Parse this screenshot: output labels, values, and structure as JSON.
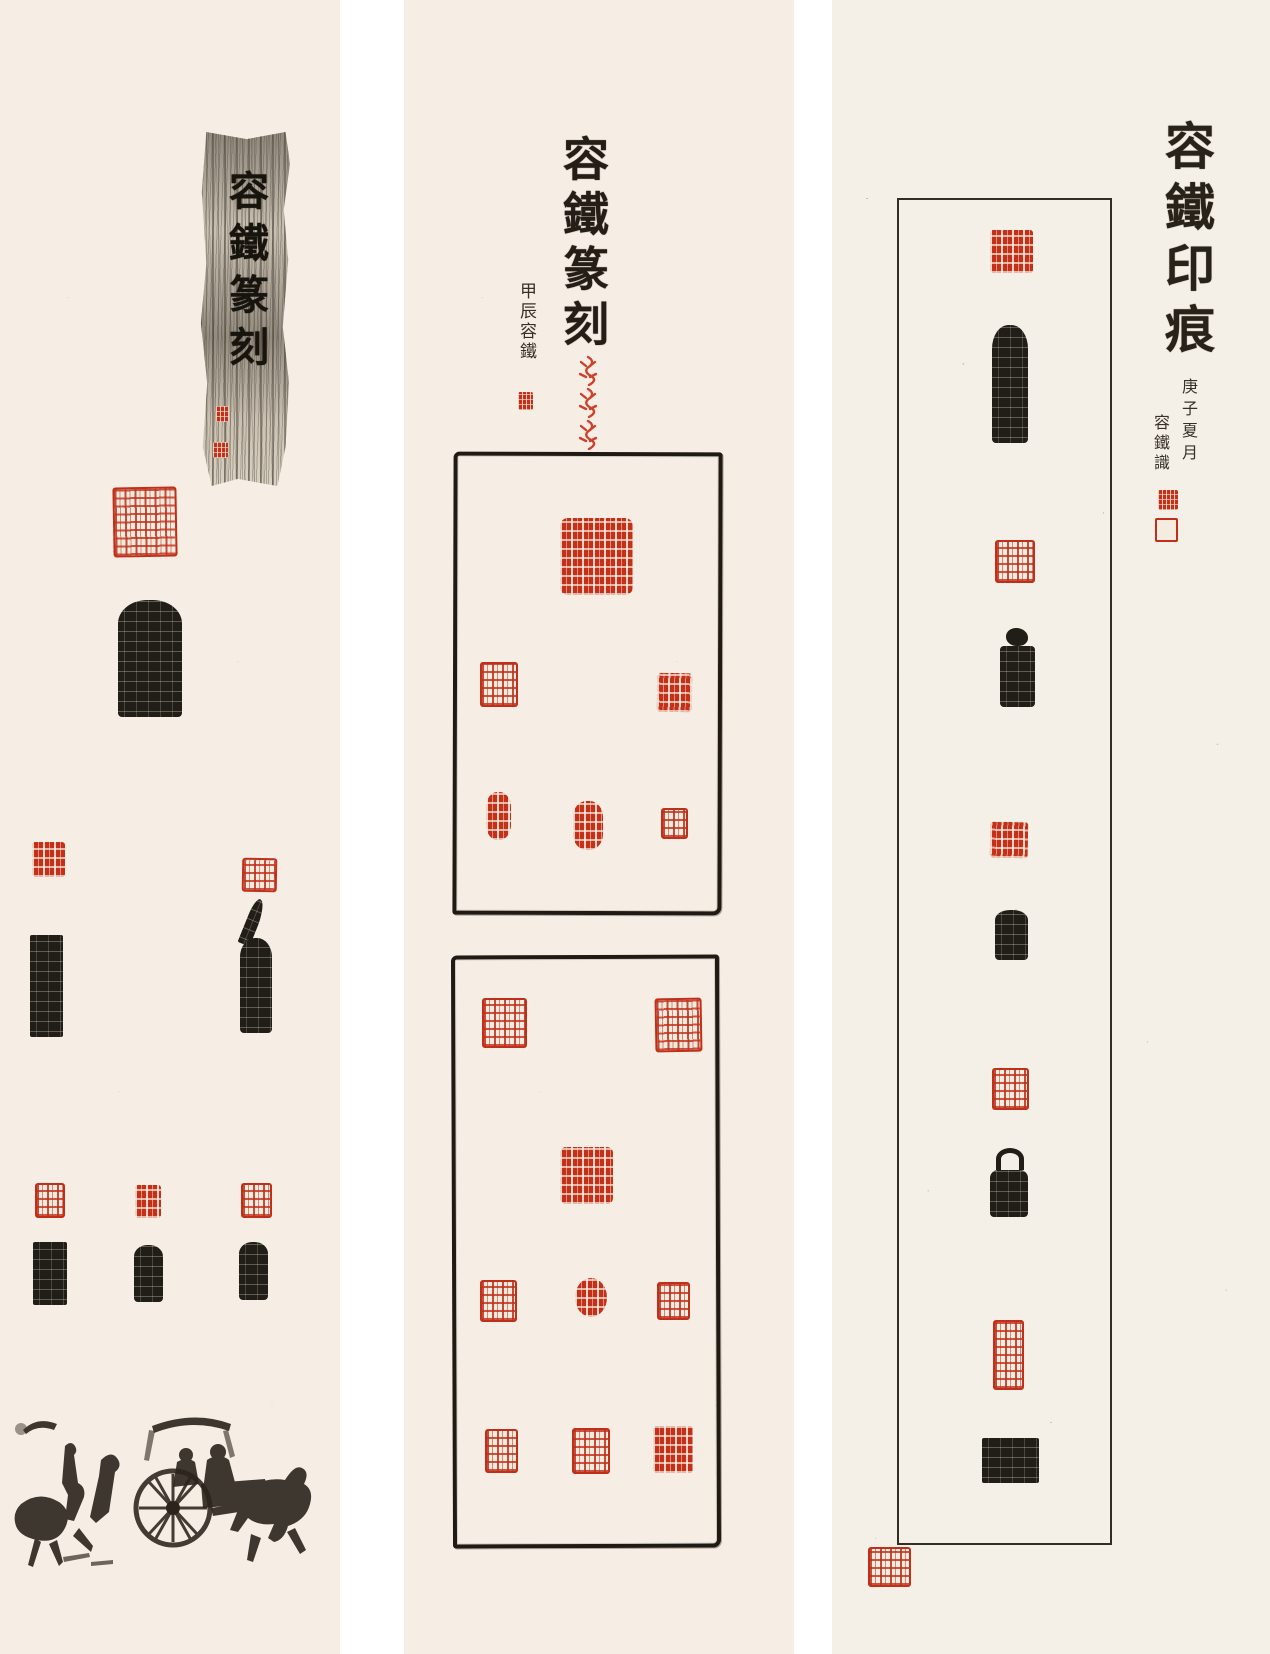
{
  "artwork": {
    "title": "容鐵篆刻 · 容鐵印痕 — Chinese seal-carving (zhuanke) triptych",
    "description": "Three vertical cream paper scrolls displaying seal carving art: red seal impressions, black seal-stone side-inscription rubbings, brush calligraphy titles, and a Han-dynasty style horse-and-chariot ink rubbing.",
    "colors": {
      "paper": "#f6eee4",
      "paper_right": "#f5f0e7",
      "gap": "#ffffff",
      "ink": "#211d17",
      "seal_red": "#c43018"
    }
  },
  "left_panel": {
    "title": "容鐵篆刻",
    "title_style": "black brush characters on a mottled gray ink-rubbing strip",
    "title_strip_seals": [
      "small red seal",
      "small red seal"
    ],
    "seals": [
      {
        "type": "red seal impression",
        "shape": "large square"
      },
      {
        "type": "black stone rubbing",
        "shape": "stele with side inscription"
      },
      {
        "type": "red seal impression",
        "shape": "square"
      },
      {
        "type": "red seal impression",
        "shape": "square"
      },
      {
        "type": "black stone rubbing",
        "shape": "tall side inscription"
      },
      {
        "type": "black stone rubbing",
        "shape": "tall side inscription with broken corner"
      },
      {
        "type": "red seal impression",
        "shape": "square"
      },
      {
        "type": "red seal impression",
        "shape": "small square"
      },
      {
        "type": "red seal impression",
        "shape": "square"
      },
      {
        "type": "black stone rubbing",
        "shape": "stele"
      },
      {
        "type": "black stone rubbing",
        "shape": "stele"
      },
      {
        "type": "black stone rubbing",
        "shape": "stele"
      }
    ],
    "illustration": "Han-dynasty style ink rubbing: two horsemen, horse-drawn chariot with large spoked wheel and canopy"
  },
  "middle_panel": {
    "title": "容鐵篆刻",
    "date_inscription": "甲辰",
    "signature": "容鐵",
    "signature_seal": "small red seal",
    "ornament": "vertical column of three red bird-and-insect script motifs",
    "frame_1": {
      "style": "hand-brushed black rectangular border",
      "seals": [
        {
          "type": "red seal impression",
          "shape": "large square"
        },
        {
          "type": "red seal impression",
          "shape": "square"
        },
        {
          "type": "red seal impression",
          "shape": "square"
        },
        {
          "type": "red seal impression",
          "shape": "oval"
        },
        {
          "type": "red seal impression",
          "shape": "oval"
        },
        {
          "type": "red seal impression",
          "shape": "small square"
        }
      ]
    },
    "frame_2": {
      "style": "hand-brushed black rectangular border",
      "seals": [
        {
          "type": "red seal impression",
          "shape": "square"
        },
        {
          "type": "red seal impression",
          "shape": "square"
        },
        {
          "type": "red seal impression",
          "shape": "square"
        },
        {
          "type": "red seal impression",
          "shape": "square"
        },
        {
          "type": "red seal impression",
          "shape": "round"
        },
        {
          "type": "red seal impression",
          "shape": "square"
        },
        {
          "type": "red seal impression",
          "shape": "square"
        },
        {
          "type": "red seal impression",
          "shape": "square"
        },
        {
          "type": "red seal impression",
          "shape": "square"
        }
      ]
    }
  },
  "right_panel": {
    "title": "容鐵印痕",
    "date_inscription": "庚子夏月",
    "signature": "容鐵識",
    "signature_seals": [
      "small red seal",
      "small red seal"
    ],
    "frame": {
      "style": "thin ruled black rectangular border",
      "items": [
        {
          "type": "red seal impression",
          "shape": "square"
        },
        {
          "type": "black stone rubbing",
          "shape": "tall stele with side inscription"
        },
        {
          "type": "red seal impression",
          "shape": "square"
        },
        {
          "type": "black stone rubbing",
          "shape": "stone with carved animal knob"
        },
        {
          "type": "red seal impression",
          "shape": "square"
        },
        {
          "type": "black stone rubbing",
          "shape": "small stele"
        },
        {
          "type": "red seal impression",
          "shape": "square"
        },
        {
          "type": "black stone rubbing",
          "shape": "stone with arched handle"
        },
        {
          "type": "red seal impression",
          "shape": "tall rectangle"
        },
        {
          "type": "black stone rubbing",
          "shape": "wide inscription block"
        }
      ]
    },
    "outside_seal": "red seal impression at lower-left corner of frame"
  }
}
